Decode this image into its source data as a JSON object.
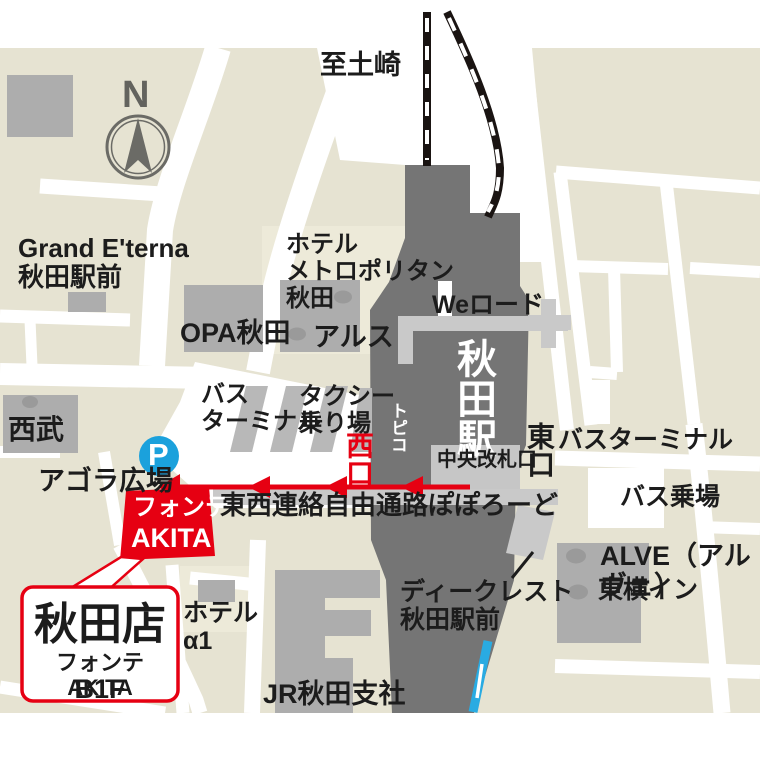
{
  "map": {
    "colors": {
      "map_background": "#e6e3d2",
      "road_white": "#ffffff",
      "station_gray": "#757575",
      "building_gray": "#adadad",
      "path_light_gray": "#c9c9c9",
      "accent_red": "#e60012",
      "parking_blue": "#1ba1dc",
      "rail_line_blue": "#29abe2",
      "text_black": "#1c1c1c"
    },
    "labels": {
      "to_tsuchizaki": "至土崎",
      "compass_n": "N",
      "grand_eterna": "Grand E'terna\n秋田駅前",
      "hotel_metropolitan": "ホテル\nメトロポリタン\n秋田",
      "opa_akita": "OPA秋田",
      "arusu": "アルス",
      "we_road": "Weロード",
      "akita_station": "秋田駅",
      "topico": "トピコ",
      "central_ticket_gate": "中央改札口",
      "west_exit": "西口",
      "east_exit": "東口",
      "bus_terminal_east": "バスターミナル",
      "bus_stop": "バス乗場",
      "bus_terminal_west": "バス\nターミナル",
      "taxi_stand": "タクシー\n乗り場",
      "seibu": "西武",
      "agora_plaza": "アゴラ広場",
      "popolo_road": "東西連絡自由通路ぽぽろーど",
      "alve": "ALVE（アルヴェ）",
      "toyoko_inn": "東横イン",
      "d_crest": "ディークレスト\n秋田駅前",
      "hotel_alpha1": "ホテル\nα1",
      "jr_akita_branch": "JR秋田支社"
    },
    "fonte_building": {
      "line1": "フォンテ",
      "line2": "AKITA"
    },
    "callout": {
      "store_name": "秋田店",
      "building": "フォンテAKITA",
      "floor": "B1F"
    },
    "parking_icon_letter": "P"
  }
}
